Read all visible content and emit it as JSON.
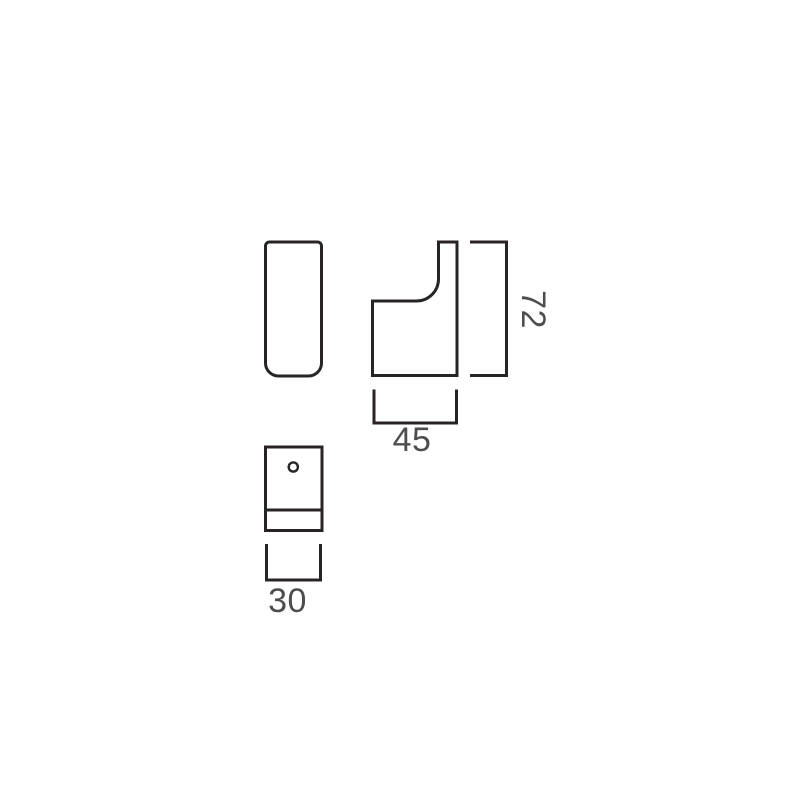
{
  "colors": {
    "background": "#ffffff",
    "outline": "#282425",
    "dimension_text": "#4d4d4f"
  },
  "dimensions": {
    "height_label": "72",
    "width_label": "45",
    "depth_label": "30"
  }
}
